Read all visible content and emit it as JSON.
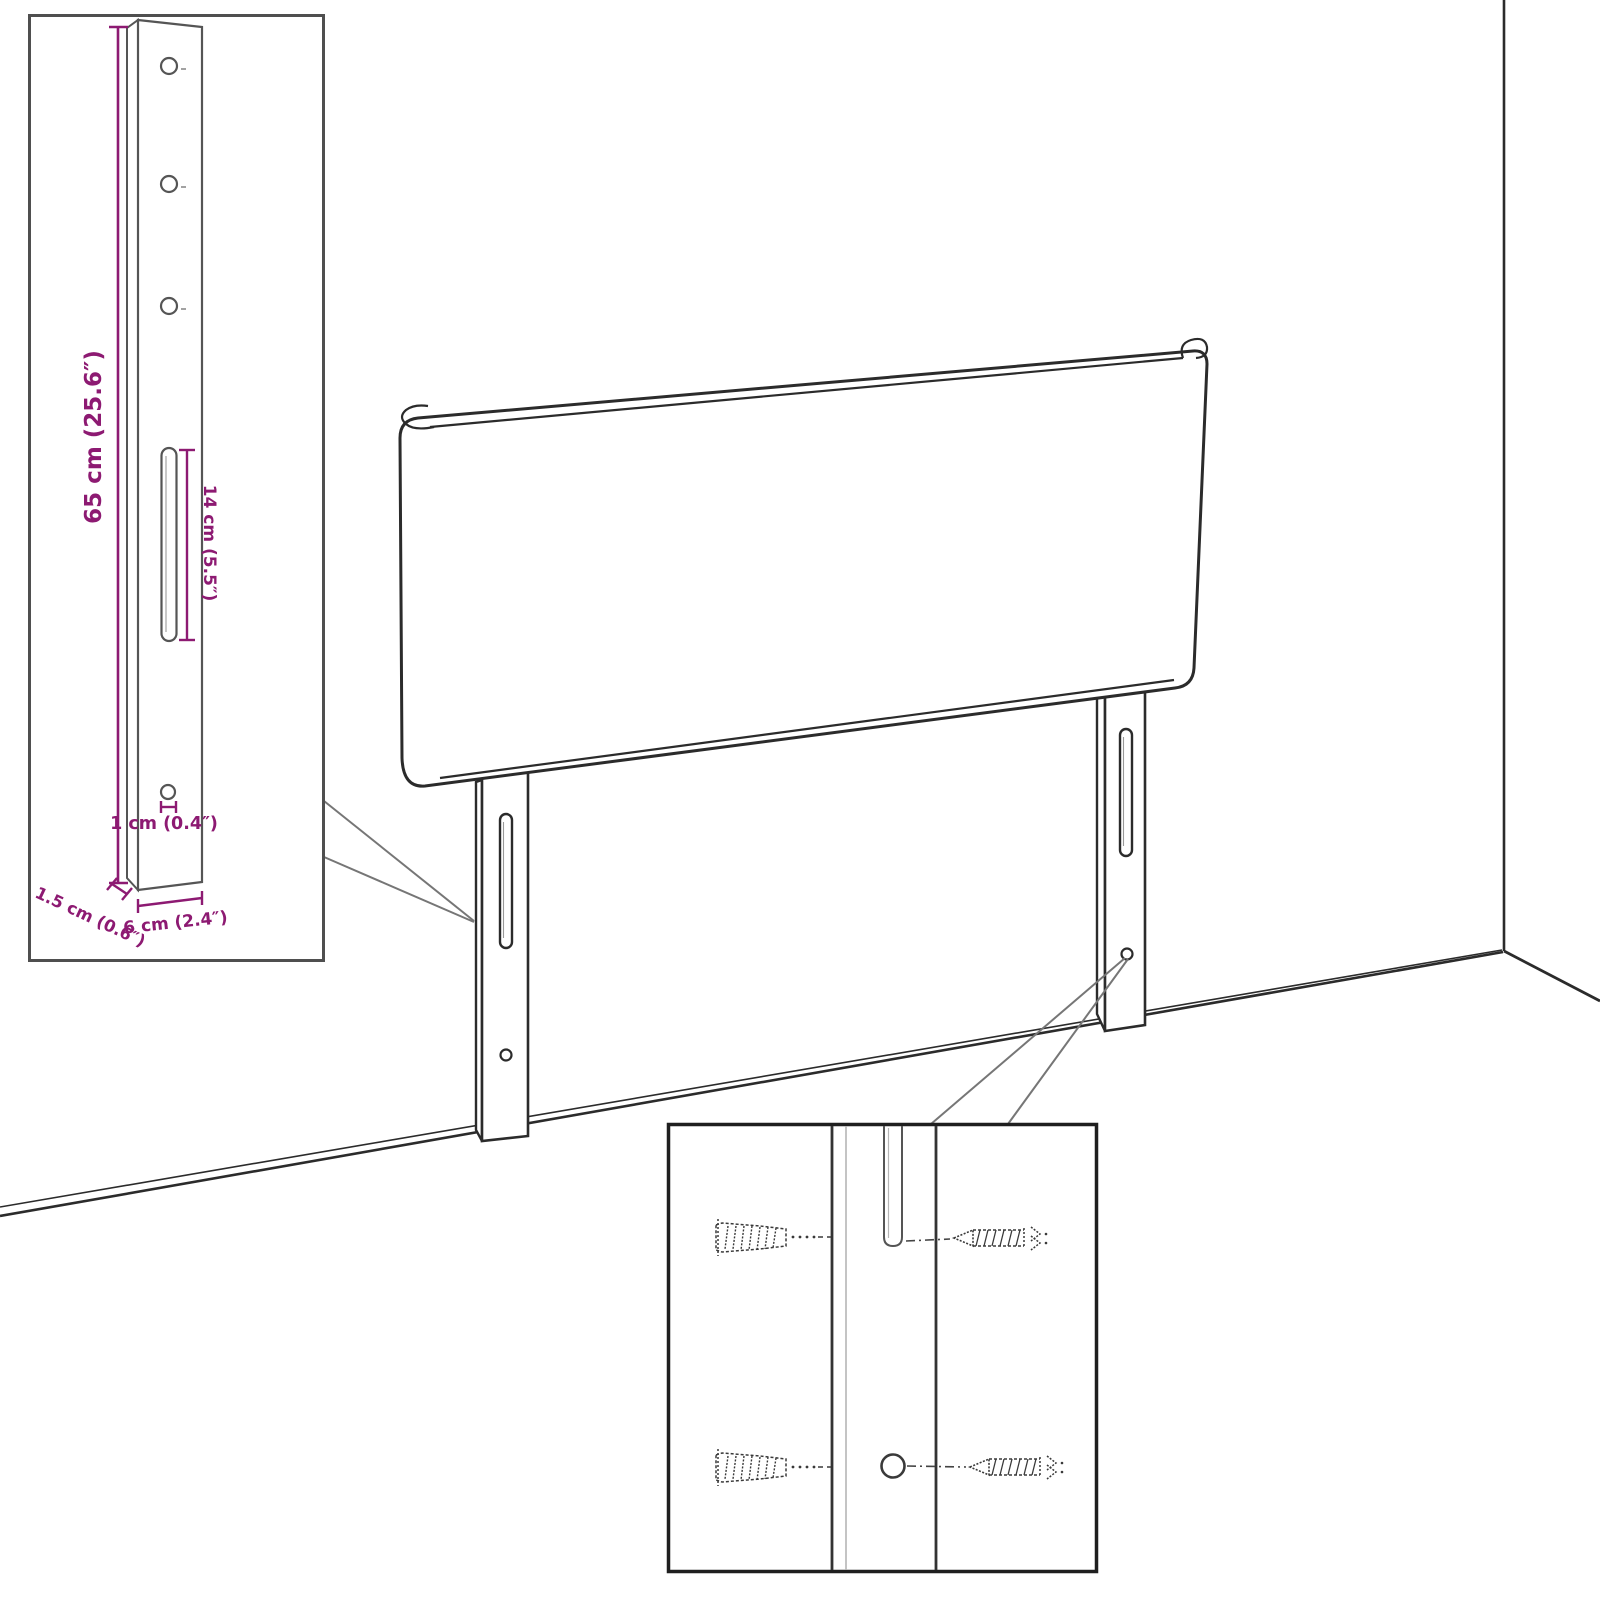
{
  "diagram": {
    "kind": "product-dimension-line-drawing",
    "subject": "upholstered headboard with two wall-mount legs, room corner backdrop",
    "views": [
      "main-perspective",
      "leg-dimension-inset",
      "mounting-hardware-inset"
    ]
  },
  "colors": {
    "accent_magenta": "#8d1a72",
    "drawing_line": "#2b2b2b",
    "inset_border_gray": "#4f4f4f",
    "detail_inset_border": "#1f1f1f",
    "callout_gray": "#767676",
    "background": "#ffffff"
  },
  "annotations": {
    "height": "65 cm (25.6″)",
    "slot_length": "14 cm (5.5″)",
    "hole_diameter": "1 cm (0.4″)",
    "depth": "1.5 cm (0.6″)",
    "width": "6 cm (2.4″)"
  },
  "icons": {
    "wall_plug": "ribbed-wall-anchor-shape, stippled outline",
    "screw": "left-pointing threaded screw with hatched shank and burst head",
    "leg_slot": "rounded vertical slot",
    "leg_hole": "small circle"
  },
  "insets": {
    "bracket_detail": {
      "content": "single mounting leg, front view, three holes, long slot, one lower hole",
      "dimension_labels": [
        "65 cm (25.6″)",
        "14 cm (5.5″)",
        "1 cm (0.4″)",
        "1.5 cm (0.6″)",
        "6 cm (2.4″)"
      ]
    },
    "mounting_detail": {
      "content": "close-up of leg slot and hole with wall plugs and screws",
      "hardware_counts": {
        "wall_plugs": 2,
        "screws": 2
      }
    }
  }
}
